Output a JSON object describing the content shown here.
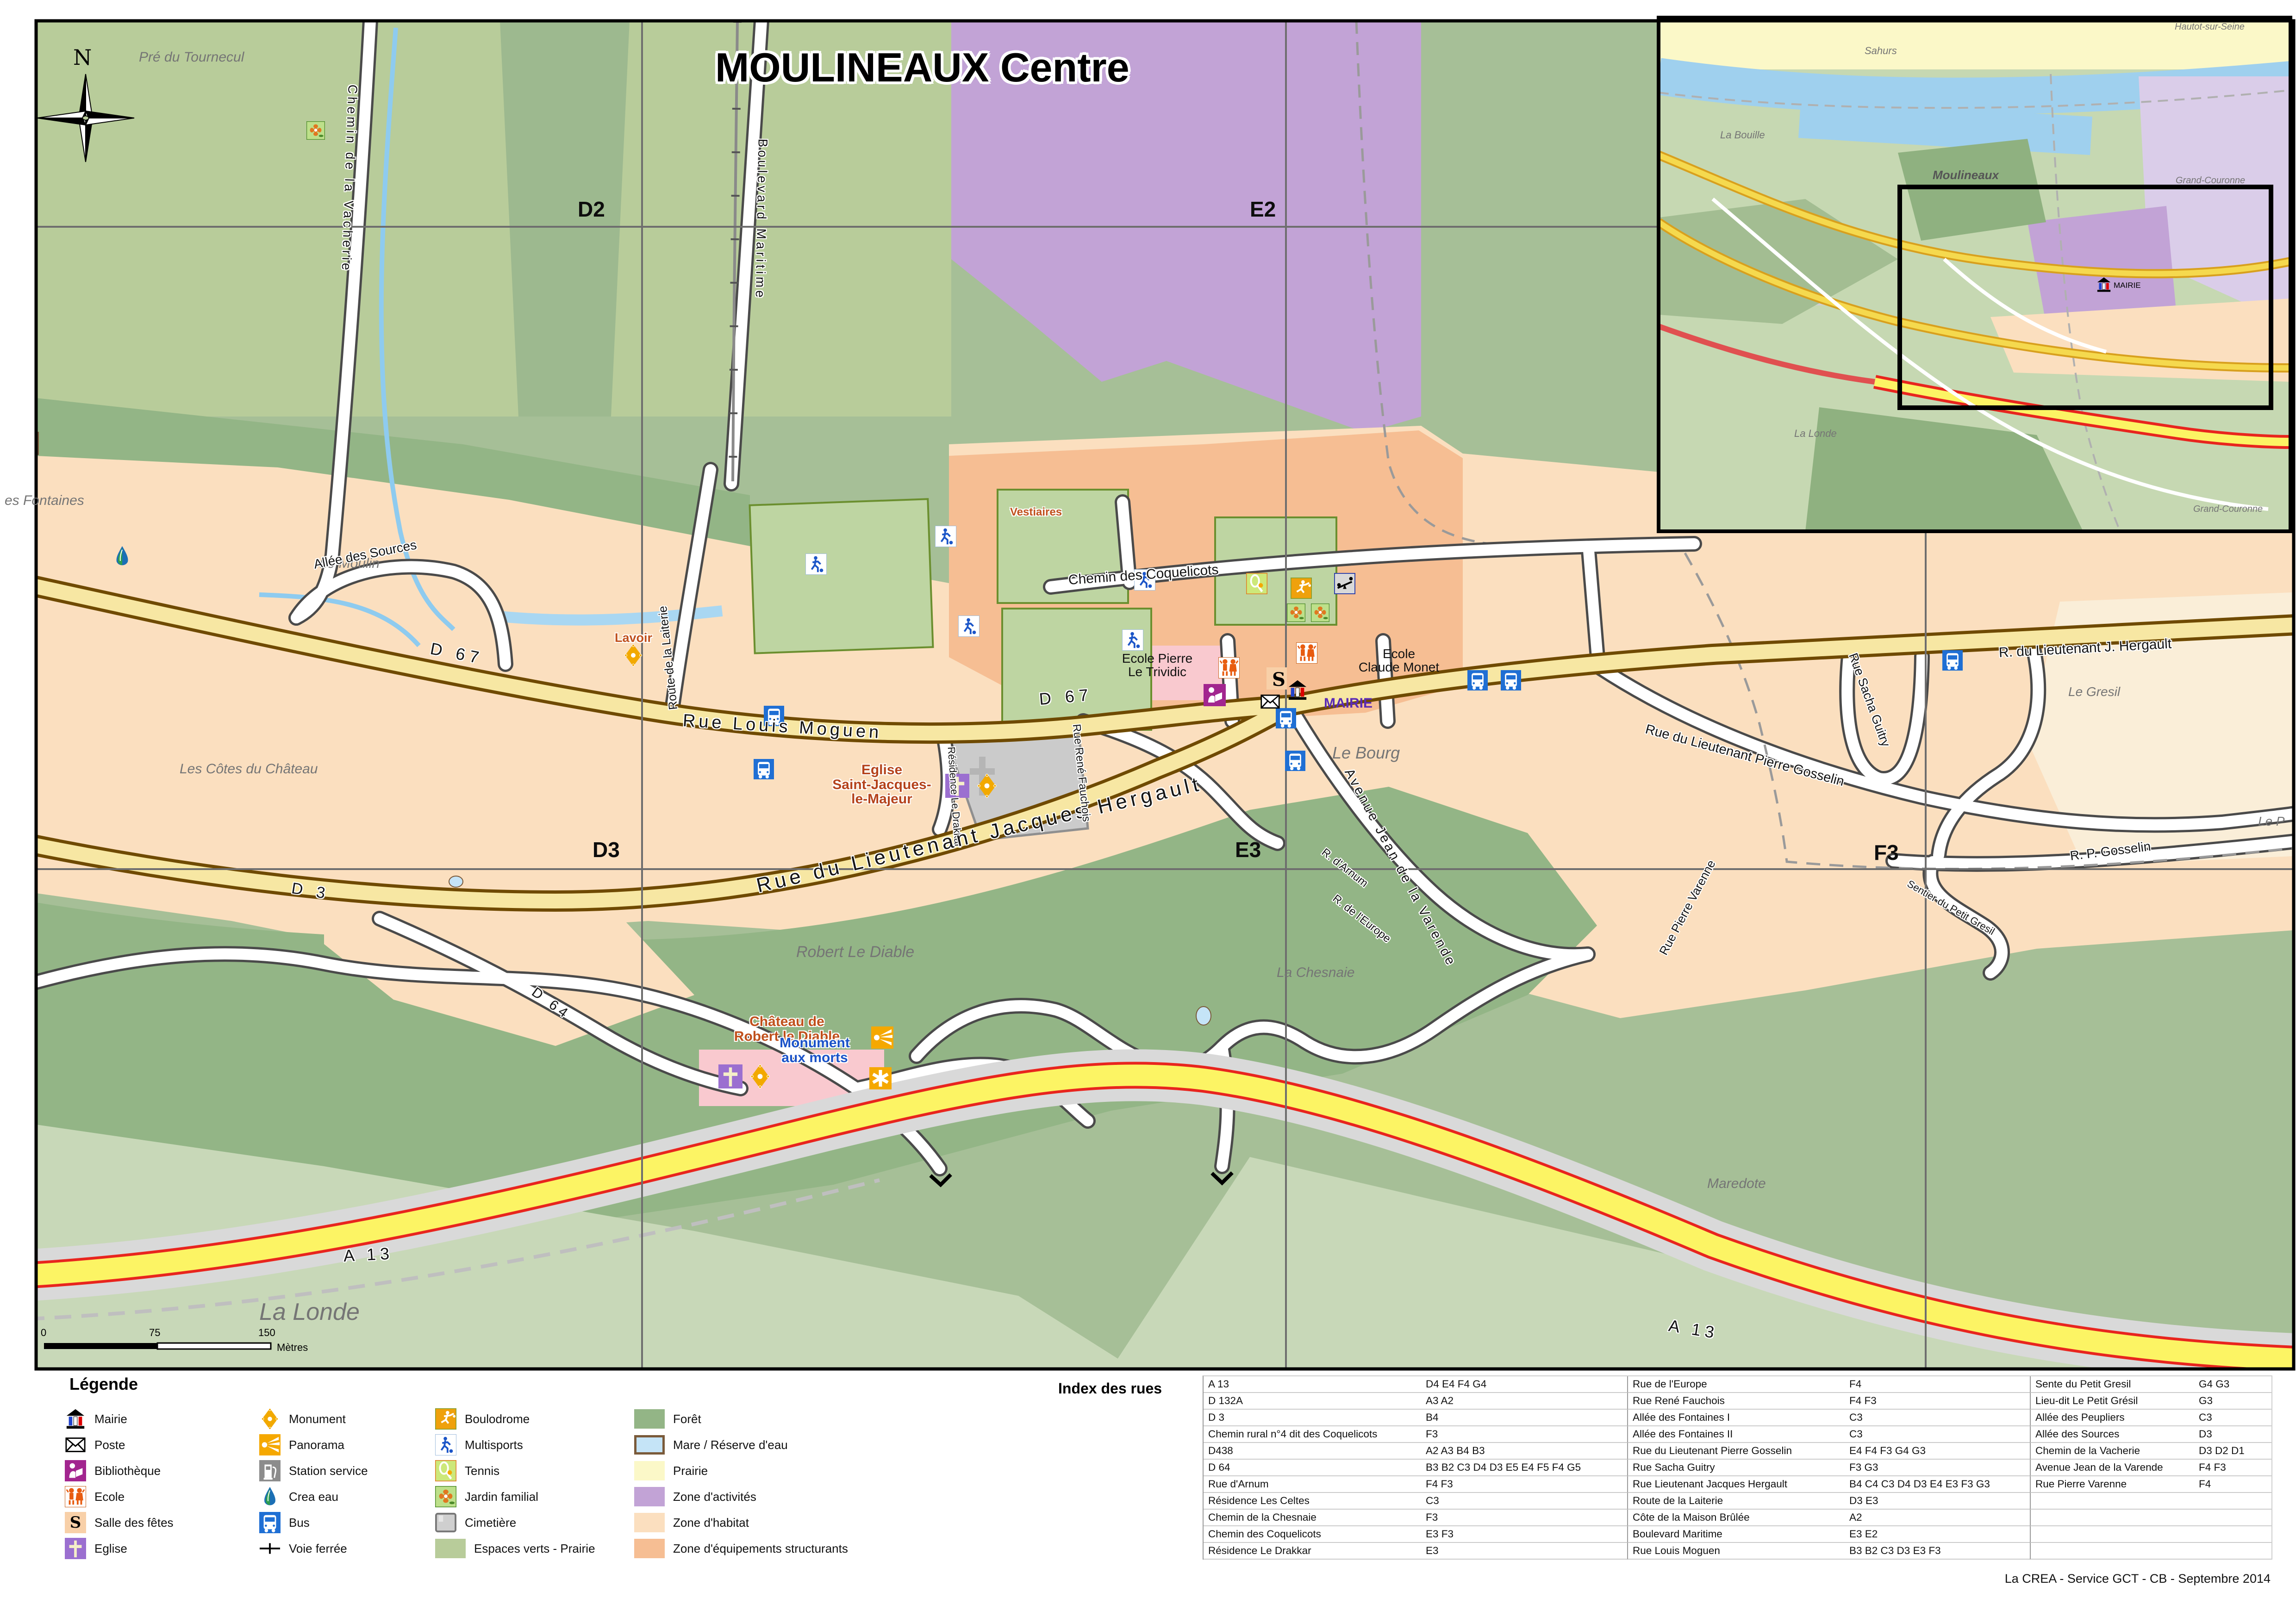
{
  "title": "MOULINEAUX Centre",
  "compass_n": "N",
  "grid_labels": {
    "d2": "D2",
    "e2": "E2",
    "d3": "D3",
    "e3": "E3",
    "f3": "F3"
  },
  "map_labels": {
    "pre_du_tournecul": "Pré du Tournecul",
    "es_fontaines": "es Fontaines",
    "le_moulin": "Le Moulin",
    "cotes_du_chateau": "Les Côtes du Château",
    "robert_le_diable": "Robert Le Diable",
    "la_chesnaie": "La Chesnaie",
    "la_londe": "La Londe",
    "maredote": "Maredote",
    "le_bourg": "Le Bourg",
    "le_gresil": "Le Gresil",
    "le_p": "Le P",
    "lavoir": "Lavoir",
    "vestiaires": "Vestiaires",
    "chateau_l1": "Château de",
    "chateau_l2": "Robert le Diable",
    "eglise_l1": "Eglise",
    "eglise_l2": "Saint-Jacques-",
    "eglise_l3": "le-Majeur",
    "monument_l1": "Monument",
    "monument_l2": "aux morts",
    "mairie": "MAIRIE",
    "ecole_trividic_l1": "Ecole Pierre",
    "ecole_trividic_l2": "Le Trividic",
    "ecole_monet_l1": "Ecole",
    "ecole_monet_l2": "Claude Monet",
    "salle_s": "S"
  },
  "street_labels": {
    "vacherie": "Chemin de la Vacherie",
    "maritime": "Boulevard Maritime",
    "sources": "Allée des Sources",
    "d67_a": "D 67",
    "d67_b": "D 67",
    "louis_moguen": "Rue Louis Moguen",
    "drakkar": "Résidence Le Drakkar",
    "laiterie": "Route de la Laiterie",
    "coquelicots": "Chemin des Coquelicots",
    "hergault_abbr": "R. du Lieutenant J. Hergault",
    "hergault": "Rue du Lieutenant Jacques Hergault",
    "sacha_guitry": "Rue Sacha Guitry",
    "pierre_gosselin": "Rue du Lieutenant Pierre Gosselin",
    "varende": "Avenue Jean de la Varende",
    "pierre_varenne": "Rue Pierre Varenne",
    "arnum": "R. d'Arnum",
    "europe": "R. de l'Europe",
    "fauchois": "Rue René Fauchois",
    "d3": "D 3",
    "d64": "D 64",
    "a13_a": "A 13",
    "a13_b": "A 13",
    "rp_gosselin": "R. P. Gosselin",
    "sentier_gresil": "Sentier du Petit Gresil"
  },
  "inset": {
    "hautot": "Hautot-sur-Seine",
    "sahurs": "Sahurs",
    "la_bouille": "La Bouille",
    "moulineaux": "Moulineaux",
    "grand_couronne_1": "Grand-Couronne",
    "grand_couronne_2": "Grand-Couronne",
    "la_londe": "La Londe",
    "mairie": "MAIRIE"
  },
  "scale": {
    "t0": "0",
    "t75": "75",
    "t150": "150",
    "unit": "Mètres"
  },
  "legend": {
    "title": "Légende",
    "col1": [
      {
        "label": "Mairie"
      },
      {
        "label": "Poste"
      },
      {
        "label": "Bibliothèque"
      },
      {
        "label": "Ecole"
      },
      {
        "label": "Salle des fêtes"
      },
      {
        "label": "Eglise"
      }
    ],
    "col2": [
      {
        "label": "Monument"
      },
      {
        "label": "Panorama"
      },
      {
        "label": "Station service"
      },
      {
        "label": "Crea eau"
      },
      {
        "label": "Bus"
      },
      {
        "label": "Voie ferrée"
      }
    ],
    "col3": [
      {
        "label": "Boulodrome"
      },
      {
        "label": "Multisports"
      },
      {
        "label": "Tennis"
      },
      {
        "label": "Jardin familial"
      },
      {
        "label": "Cimetière"
      },
      {
        "label": "Espaces verts - Prairie"
      }
    ],
    "col4": [
      {
        "label": "Forêt"
      },
      {
        "label": "Mare / Réserve d'eau"
      },
      {
        "label": "Prairie"
      },
      {
        "label": "Zone d'activités"
      },
      {
        "label": "Zone d'habitat"
      },
      {
        "label": "Zone d'équipements structurants"
      }
    ]
  },
  "index": {
    "title": "Index des rues",
    "g1": [
      {
        "name": "A 13",
        "refs": "D4 E4 F4 G4"
      },
      {
        "name": "D 132A",
        "refs": "A3 A2"
      },
      {
        "name": "D 3",
        "refs": "B4"
      },
      {
        "name": "Chemin rural n°4 dit des Coquelicots",
        "refs": "F3"
      },
      {
        "name": "D438",
        "refs": "A2 A3 B4 B3"
      },
      {
        "name": "D 64",
        "refs": "B3 B2 C3 D4 D3 E5 E4 F5 F4 G5"
      },
      {
        "name": "Rue d'Arnum",
        "refs": "F4 F3"
      },
      {
        "name": "Résidence Les Celtes",
        "refs": "C3"
      },
      {
        "name": "Chemin de la Chesnaie",
        "refs": "F3"
      },
      {
        "name": "Chemin des Coquelicots",
        "refs": "E3 F3"
      },
      {
        "name": "Résidence Le Drakkar",
        "refs": "E3"
      }
    ],
    "g2": [
      {
        "name": "Rue de l'Europe",
        "refs": "F4"
      },
      {
        "name": "Rue René Fauchois",
        "refs": "F4 F3"
      },
      {
        "name": "Allée des Fontaines I",
        "refs": "C3"
      },
      {
        "name": "Allée des Fontaines II",
        "refs": "C3"
      },
      {
        "name": "Rue du Lieutenant Pierre Gosselin",
        "refs": "E4 F4 F3 G4 G3"
      },
      {
        "name": "Rue Sacha Guitry",
        "refs": "F3 G3"
      },
      {
        "name": "Rue Lieutenant Jacques Hergault",
        "refs": "B4 C4 C3 D4 D3 E4 E3 F3 G3"
      },
      {
        "name": "Route de la Laiterie",
        "refs": "D3 E3"
      },
      {
        "name": "Côte de la Maison Brûlée",
        "refs": "A2"
      },
      {
        "name": "Boulevard Maritime",
        "refs": "E3 E2"
      },
      {
        "name": "Rue Louis Moguen",
        "refs": "B3 B2 C3 D3 E3 F3"
      }
    ],
    "g3": [
      {
        "name": "Sente du Petit Gresil",
        "refs": "G4 G3"
      },
      {
        "name": "Lieu-dit Le Petit Grésil",
        "refs": "G3"
      },
      {
        "name": "Allée des Peupliers",
        "refs": "C3"
      },
      {
        "name": "Allée des Sources",
        "refs": "D3"
      },
      {
        "name": "Chemin de la Vacherie",
        "refs": "D3 D2 D1"
      },
      {
        "name": "Avenue Jean de la Varende",
        "refs": "F4 F3"
      },
      {
        "name": "Rue Pierre Varenne",
        "refs": "F4"
      }
    ]
  },
  "attribution": "La CREA - Service GCT - CB - Septembre 2014",
  "colors": {
    "forest": "#93B586",
    "espaces_verts": "#B8CC9A",
    "pale_green": "#C8D8B8",
    "habitat": "#FBDFBF",
    "equipements": "#F6BE93",
    "activites": "#C2A3D6",
    "prairie": "#FBF8C8",
    "mare": "#C5E4F7",
    "road_major_fill": "#F7E7A3",
    "road_major_casing": "#6F4A00",
    "a13_yellow": "#FCF464",
    "a13_red": "#E8251E"
  }
}
